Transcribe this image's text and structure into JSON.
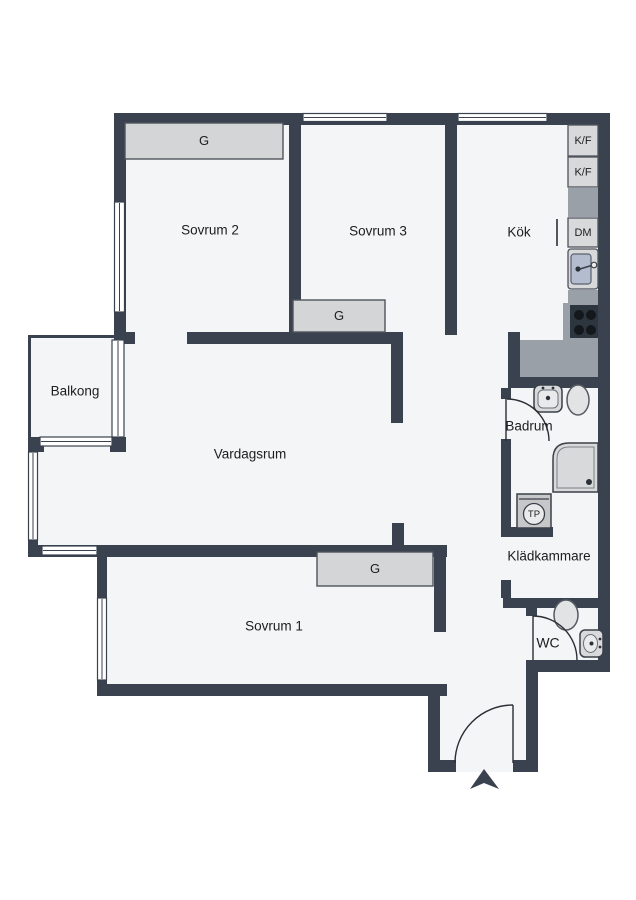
{
  "plan": {
    "width": 636,
    "height": 900,
    "colors": {
      "background": "#ffffff",
      "floor": "#f4f5f7",
      "wall": "#39424e",
      "outline": "#4e545c",
      "thin_line": "#2a2f35",
      "counter": "#9aa0a8",
      "unit_fill": "#d8d9db",
      "unit_inner": "#e9eaeb",
      "closet_fill": "#d4d5d7",
      "sink_blue": "#b4bdcf",
      "stove_dark": "#2d353e",
      "burner": "#14181c",
      "toilet_fill": "#e2e3e5",
      "text": "#1b1d1f"
    },
    "floor_rects": [
      [
        118,
        113,
        486,
        559
      ],
      [
        28,
        445,
        90,
        112
      ],
      [
        28,
        335,
        90,
        110
      ],
      [
        97,
        545,
        350,
        150
      ],
      [
        428,
        557,
        109,
        215
      ]
    ],
    "balcony_rails": [
      [
        28,
        335,
        3,
        110
      ],
      [
        28,
        335,
        90,
        3
      ]
    ],
    "walls": [
      [
        114,
        113,
        496,
        12
      ],
      [
        598,
        113,
        12,
        559
      ],
      [
        114,
        113,
        12,
        227
      ],
      [
        289,
        113,
        12,
        219
      ],
      [
        445,
        113,
        12,
        222
      ],
      [
        114,
        332,
        21,
        12
      ],
      [
        187,
        332,
        216,
        12
      ],
      [
        391,
        340,
        12,
        83
      ],
      [
        508,
        332,
        12,
        50
      ],
      [
        508,
        376,
        102,
        12
      ],
      [
        501,
        388,
        10,
        11
      ],
      [
        501,
        439,
        10,
        98
      ],
      [
        501,
        527,
        52,
        10
      ],
      [
        501,
        580,
        10,
        18
      ],
      [
        503,
        598,
        97,
        10
      ],
      [
        526,
        598,
        11,
        18
      ],
      [
        526,
        660,
        84,
        12
      ],
      [
        526,
        660,
        12,
        112
      ],
      [
        513,
        760,
        25,
        12
      ],
      [
        428,
        760,
        28,
        12
      ],
      [
        428,
        684,
        12,
        88
      ],
      [
        97,
        684,
        350,
        12
      ],
      [
        97,
        545,
        10,
        151
      ],
      [
        28,
        545,
        79,
        12
      ],
      [
        28,
        437,
        10,
        120
      ],
      [
        97,
        545,
        350,
        12
      ],
      [
        434,
        557,
        12,
        75
      ],
      [
        392,
        523,
        12,
        34
      ],
      [
        110,
        437,
        16,
        15
      ],
      [
        28,
        437,
        16,
        15
      ]
    ],
    "windows": [
      {
        "name": "window-sovrum3-top",
        "x": 303,
        "y": 113.5,
        "w": 84,
        "h": 8,
        "o": "h"
      },
      {
        "name": "window-kok-top",
        "x": 458,
        "y": 113.5,
        "w": 89,
        "h": 8,
        "o": "h"
      },
      {
        "name": "window-sovrum2-left",
        "x": 114.5,
        "y": 202,
        "w": 10,
        "h": 110,
        "o": "v"
      },
      {
        "name": "balcony-door",
        "x": 112,
        "y": 340,
        "w": 12,
        "h": 97,
        "o": "v"
      },
      {
        "name": "window-balcony-bottom",
        "x": 40,
        "y": 437,
        "w": 72,
        "h": 9,
        "o": "h"
      },
      {
        "name": "window-vardagsrum-left",
        "x": 28.5,
        "y": 452,
        "w": 9,
        "h": 88,
        "o": "v"
      },
      {
        "name": "window-vardagsrum-bottom",
        "x": 42,
        "y": 546,
        "w": 55,
        "h": 9,
        "o": "h"
      },
      {
        "name": "window-sovrum1-left",
        "x": 97.5,
        "y": 598,
        "w": 9,
        "h": 82,
        "o": "v"
      }
    ],
    "closets": [
      {
        "label": "G",
        "x": 125,
        "y": 123,
        "w": 158,
        "h": 36
      },
      {
        "label": "G",
        "x": 293,
        "y": 300,
        "w": 92,
        "h": 32
      },
      {
        "label": "G",
        "x": 317,
        "y": 552,
        "w": 116,
        "h": 34
      }
    ],
    "kitchen": {
      "units": [
        {
          "type": "box",
          "name": "fridge-freezer-unit",
          "label": "K/F",
          "x": 568,
          "y": 125,
          "w": 30,
          "h": 31
        },
        {
          "type": "box",
          "name": "fridge-freezer-unit",
          "label": "K/F",
          "x": 568,
          "y": 157,
          "w": 30,
          "h": 30
        },
        {
          "type": "counter",
          "name": "kitchen-counter",
          "x": 568,
          "y": 188,
          "w": 30,
          "h": 29
        },
        {
          "type": "box",
          "name": "dishwasher-unit",
          "label": "DM",
          "x": 568,
          "y": 218,
          "w": 30,
          "h": 29
        },
        {
          "type": "sink",
          "name": "kitchen-sink",
          "x": 568,
          "y": 249,
          "w": 30,
          "h": 40
        },
        {
          "type": "counter",
          "name": "kitchen-counter",
          "x": 568,
          "y": 290,
          "w": 30,
          "h": 15
        },
        {
          "type": "counter",
          "name": "stove-surround",
          "x": 563,
          "y": 303,
          "w": 35,
          "h": 38
        },
        {
          "type": "counter",
          "name": "kitchen-counter",
          "x": 520,
          "y": 340,
          "w": 78,
          "h": 37
        },
        {
          "type": "stove",
          "name": "stove",
          "x": 570,
          "y": 305,
          "w": 28,
          "h": 33
        }
      ],
      "burners": [
        [
          579,
          315
        ],
        [
          591,
          315
        ],
        [
          579,
          330
        ],
        [
          591,
          330
        ]
      ],
      "dm_door_line": {
        "x": 557,
        "y1": 219,
        "y2": 246
      }
    },
    "bath_fixtures": [
      {
        "type": "bsink",
        "name": "bathroom-sink",
        "x": 534,
        "y": 385,
        "w": 28,
        "h": 27
      },
      {
        "type": "toilet",
        "name": "toilet",
        "cx": 578,
        "cy": 400,
        "rx": 11,
        "ry": 15
      },
      {
        "type": "shower",
        "name": "shower",
        "x": 553,
        "y": 443,
        "w": 45,
        "h": 49,
        "r": 16
      },
      {
        "type": "tp",
        "name": "washer-tp",
        "label": "TP",
        "x": 517,
        "y": 494,
        "w": 34,
        "h": 34
      },
      {
        "type": "toilet",
        "name": "toilet",
        "cx": 566,
        "cy": 615,
        "rx": 12,
        "ry": 15
      },
      {
        "type": "wcsink",
        "name": "wc-sink",
        "x": 580,
        "y": 630,
        "w": 23,
        "h": 27
      }
    ],
    "doors": [
      {
        "name": "badrum-door",
        "arc": "M 507 399 A 42 42 0 0 1 549 441",
        "leaf": [
          506,
          399,
          506,
          441
        ]
      },
      {
        "name": "wc-door",
        "arc": "M 533 616 A 44 44 0 0 1 577 660",
        "leaf": [
          533,
          616,
          533,
          660
        ]
      },
      {
        "name": "entrance-door",
        "arc": "M 513 705 A 58 58 0 0 0 455 763",
        "leaf": [
          513,
          705,
          513,
          763
        ]
      }
    ],
    "entrance_arrow": {
      "points": "484,769 499,789 484,783 470,789"
    },
    "labels": [
      {
        "text": "Sovrum 2",
        "x": 210,
        "y": 231,
        "size": 13.5
      },
      {
        "text": "Sovrum 3",
        "x": 378,
        "y": 232,
        "size": 13.5
      },
      {
        "text": "Kök",
        "x": 519,
        "y": 233,
        "size": 13.5
      },
      {
        "text": "Balkong",
        "x": 75,
        "y": 392,
        "size": 13.5
      },
      {
        "text": "Vardagsrum",
        "x": 250,
        "y": 455,
        "size": 13.5
      },
      {
        "text": "Badrum",
        "x": 529,
        "y": 427,
        "size": 13.5
      },
      {
        "text": "Klädkammare",
        "x": 549,
        "y": 557,
        "size": 13.5
      },
      {
        "text": "WC",
        "x": 548,
        "y": 644,
        "size": 14
      },
      {
        "text": "Sovrum 1",
        "x": 274,
        "y": 627,
        "size": 13.5
      }
    ]
  }
}
